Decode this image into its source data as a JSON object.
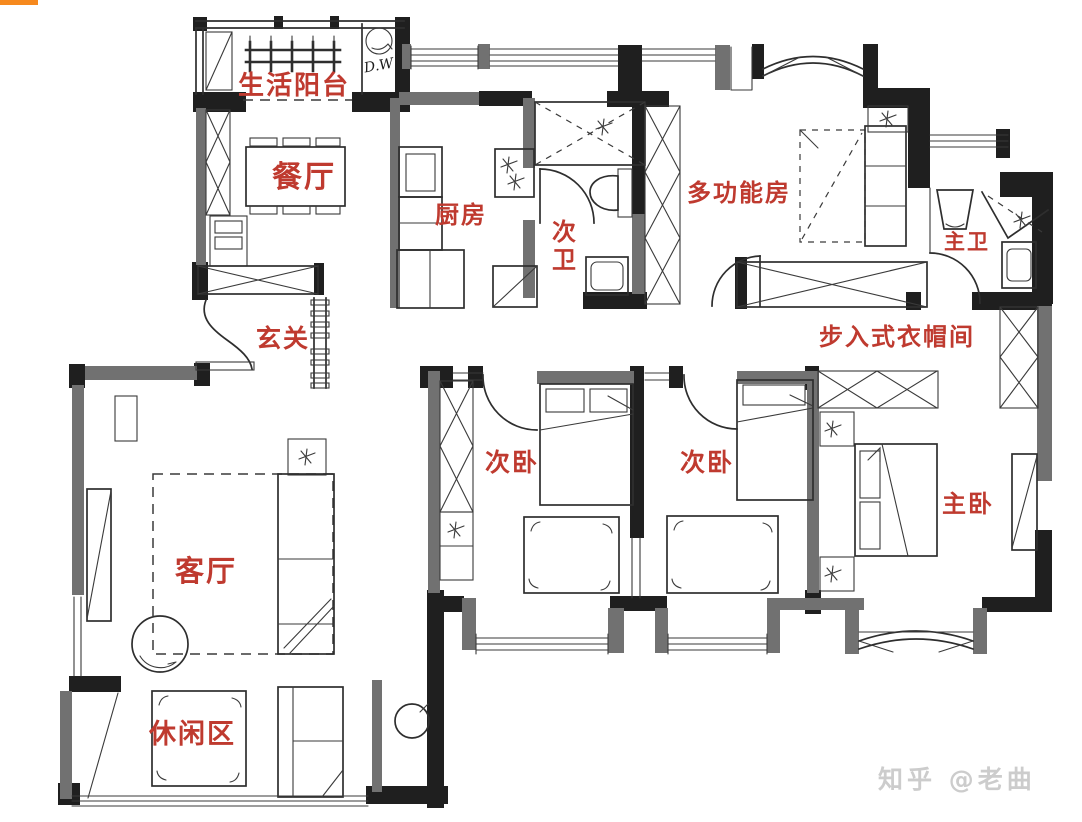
{
  "canvas": {
    "width": 1082,
    "height": 822,
    "background": "#ffffff"
  },
  "colors": {
    "room_label": "#bf3a2f",
    "wall_black": "#1f1f1f",
    "wall_gray": "#717171",
    "line": "#2e2e2e",
    "orange_marker": "#f6891e",
    "watermark": "#cccccc"
  },
  "floor_plan": {
    "type": "hand-drawn apartment floor plan",
    "rooms": [
      {
        "id": "laundry-balcony",
        "label": "生活阳台"
      },
      {
        "id": "dining-room",
        "label": "餐厅"
      },
      {
        "id": "kitchen",
        "label": "厨房"
      },
      {
        "id": "second-bathroom",
        "label": "次卫"
      },
      {
        "id": "multifunction-room",
        "label": "多功能房"
      },
      {
        "id": "master-bathroom",
        "label": "主卫"
      },
      {
        "id": "entryway",
        "label": "玄关"
      },
      {
        "id": "walk-in-closet",
        "label": "步入式衣帽间"
      },
      {
        "id": "second-bedroom-left",
        "label": "次卧"
      },
      {
        "id": "second-bedroom-right",
        "label": "次卧"
      },
      {
        "id": "master-bedroom",
        "label": "主卧"
      },
      {
        "id": "living-room",
        "label": "客厅"
      },
      {
        "id": "leisure-area",
        "label": "休闲区"
      }
    ],
    "annotations": {
      "appliance_note": "D.W"
    }
  },
  "watermark": {
    "text": "知乎 @老曲"
  }
}
